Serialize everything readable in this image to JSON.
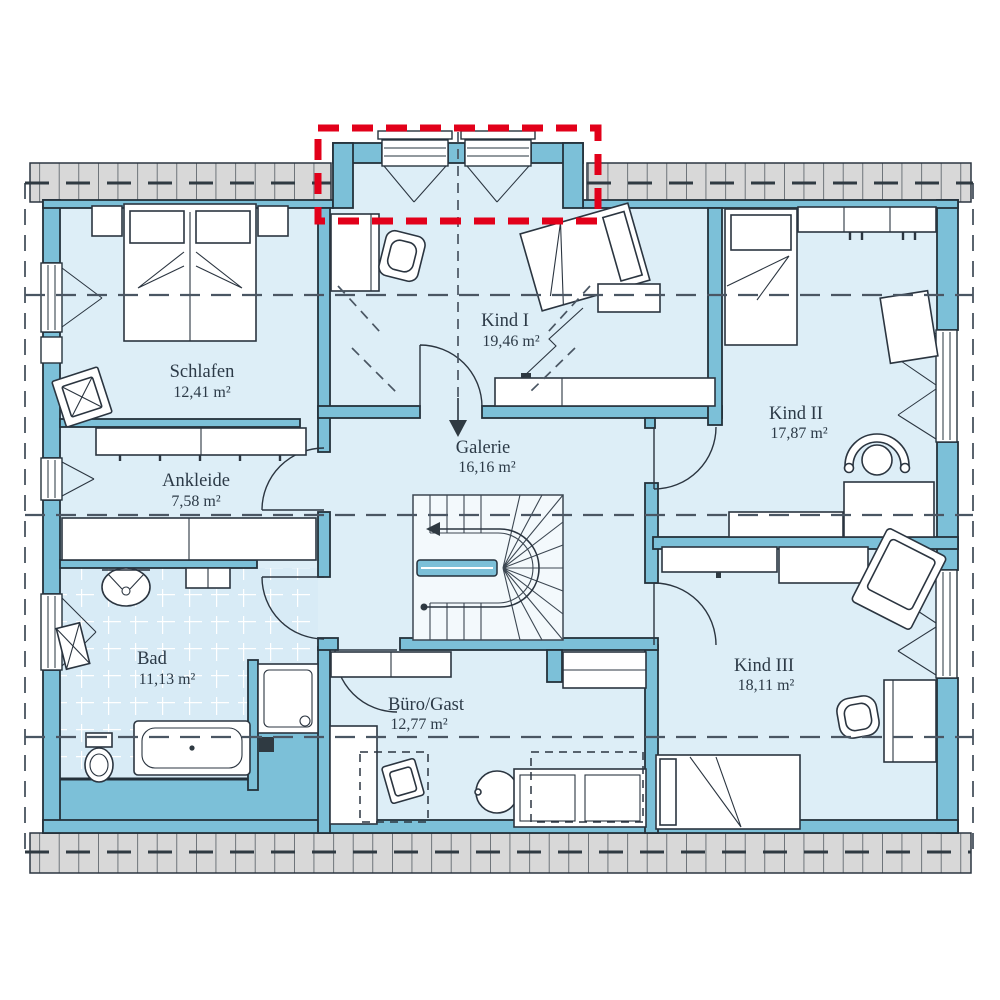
{
  "plan": {
    "type": "floor-plan-upper-storey",
    "rooms": [
      {
        "id": "schlafen",
        "name": "Schlafen",
        "area": "12,41 m²"
      },
      {
        "id": "ankleide",
        "name": "Ankleide",
        "area": "7,58 m²"
      },
      {
        "id": "bad",
        "name": "Bad",
        "area": "11,13 m²"
      },
      {
        "id": "kind-1",
        "name": "Kind I",
        "area": "19,46 m²"
      },
      {
        "id": "galerie",
        "name": "Galerie",
        "area": "16,16 m²"
      },
      {
        "id": "kind-2",
        "name": "Kind II",
        "area": "17,87 m²"
      },
      {
        "id": "kind-3",
        "name": "Kind III",
        "area": "18,11 m²"
      },
      {
        "id": "buero-gast",
        "name": "Büro/Gast",
        "area": "12,77 m²"
      }
    ],
    "colors": {
      "wall": "#7cc0d8",
      "room_fill": "#ddeef7",
      "outline": "#24313b",
      "roof_band": "#d8d8d8",
      "highlight_red": "#e2001a",
      "text": "#2c3a47"
    }
  }
}
